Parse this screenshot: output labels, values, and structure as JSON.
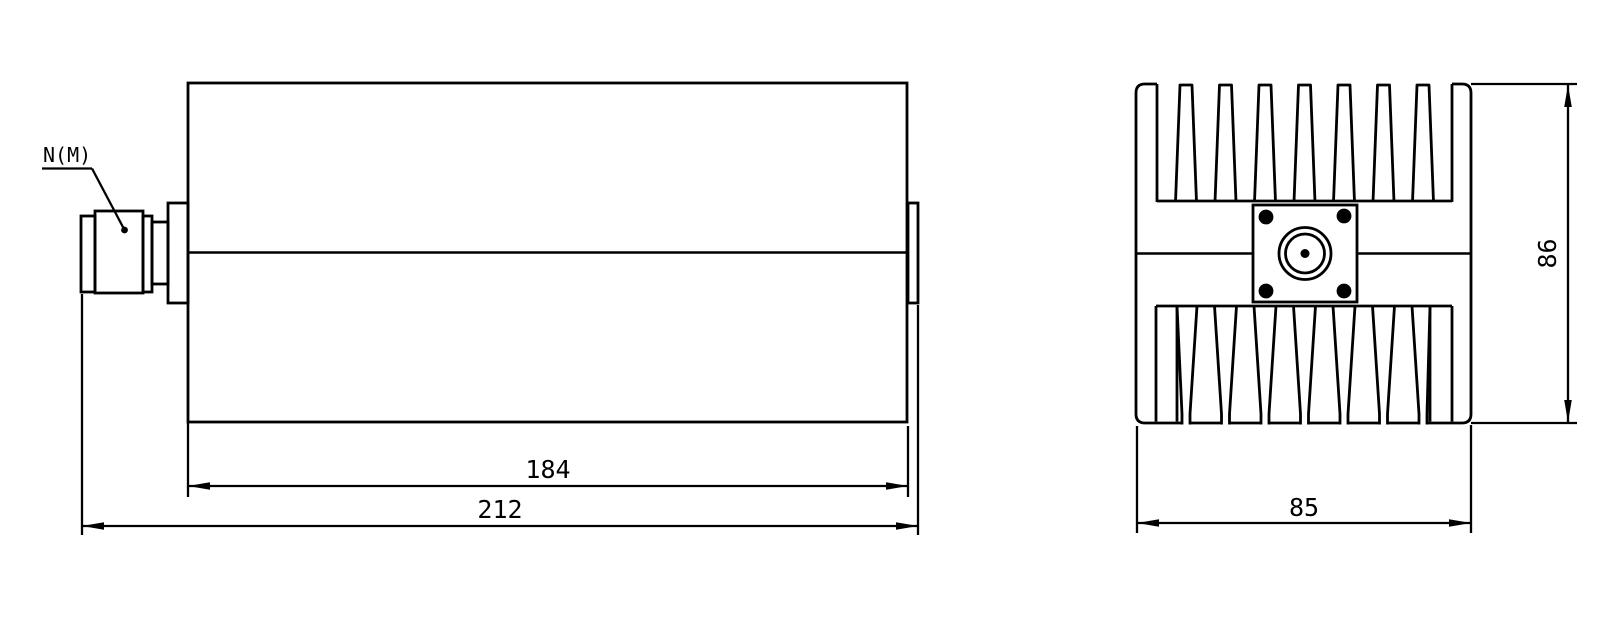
{
  "colors": {
    "background": "#ffffff",
    "line": "#000000"
  },
  "side_view": {
    "connector_label": "N(M)",
    "dim_body_length": "184",
    "dim_overall_length": "212"
  },
  "end_view": {
    "dim_width": "85",
    "dim_height": "86"
  }
}
